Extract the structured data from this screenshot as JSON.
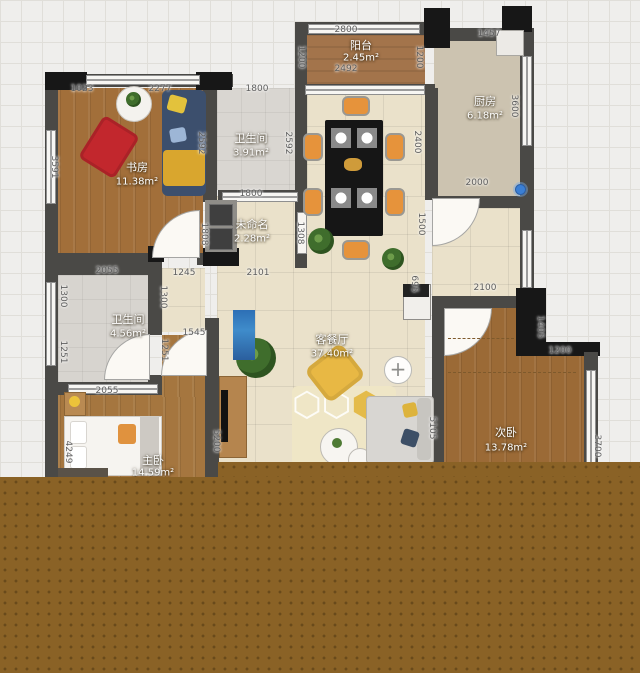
{
  "rooms": [
    {
      "id": "study",
      "name": "书房",
      "area": "11.38m²"
    },
    {
      "id": "bath-top",
      "name": "卫生间",
      "area": "3.91m²"
    },
    {
      "id": "unnamed",
      "name": "未命名",
      "area": "2.28m²"
    },
    {
      "id": "balcony",
      "name": "阳台",
      "area": "2.45m²"
    },
    {
      "id": "kitchen",
      "name": "厨房",
      "area": "6.18m²"
    },
    {
      "id": "bath-left",
      "name": "卫生间",
      "area": "4.56m²"
    },
    {
      "id": "living-dining",
      "name": "客餐厅",
      "area": "37.40m²"
    },
    {
      "id": "master-bedroom",
      "name": "主卧",
      "area": "14.59m²"
    },
    {
      "id": "second-bedroom",
      "name": "次卧",
      "area": "13.78m²"
    }
  ],
  "dimensions": [
    "1023",
    "2277",
    "1800",
    "2800",
    "2492",
    "1200",
    "1200",
    "1457",
    "3600",
    "2000",
    "2592",
    "2592",
    "2400",
    "1800",
    "1808",
    "1308",
    "2101",
    "1245",
    "1500",
    "695",
    "3591",
    "2055",
    "1300",
    "1300",
    "1251",
    "1251",
    "1545",
    "2055",
    "4249",
    "5200",
    "2100",
    "1405",
    "1200",
    "3700",
    "5105"
  ],
  "icons": {
    "plus": "+"
  },
  "colors": {
    "overlay_brown": "#8a6226",
    "wall_gray": "#4a4946",
    "wall_black": "#171717",
    "wood_floor": "#a26f3a",
    "tile_floor": "#eae1ca",
    "chair_orange": "#e6933b",
    "pin_blue": "#3b7fd4"
  }
}
